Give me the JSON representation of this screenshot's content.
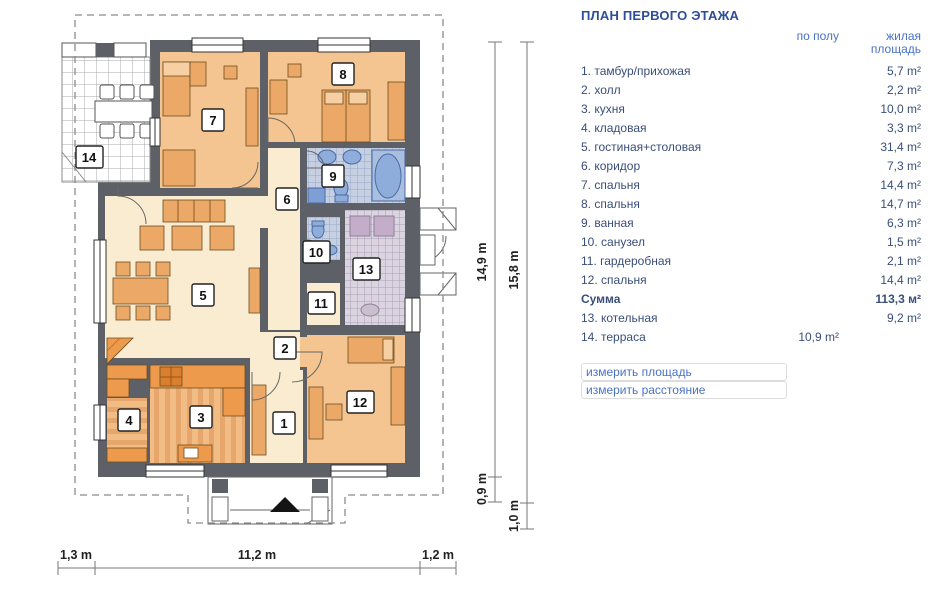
{
  "panel": {
    "title": "ПЛАН ПЕРВОГО ЭТАЖА",
    "col1_header": "по полу",
    "col2_header": "жилая площадь",
    "rows": [
      {
        "name": "1. тамбур/прихожая",
        "c1": "",
        "c2": "5,7 m²"
      },
      {
        "name": "2. холл",
        "c1": "",
        "c2": "2,2 m²"
      },
      {
        "name": "3. кухня",
        "c1": "",
        "c2": "10,0 m²"
      },
      {
        "name": "4. кладовая",
        "c1": "",
        "c2": "3,3 m²"
      },
      {
        "name": "5. гостиная+столовая",
        "c1": "",
        "c2": "31,4 m²"
      },
      {
        "name": "6. коридор",
        "c1": "",
        "c2": "7,3 m²"
      },
      {
        "name": "7. спальня",
        "c1": "",
        "c2": "14,4 m²"
      },
      {
        "name": "8. спальня",
        "c1": "",
        "c2": "14,7 m²"
      },
      {
        "name": "9. ванная",
        "c1": "",
        "c2": "6,3 m²"
      },
      {
        "name": "10. санузел",
        "c1": "",
        "c2": "1,5 m²"
      },
      {
        "name": "11. гардеробная",
        "c1": "",
        "c2": "2,1 m²"
      },
      {
        "name": "12. спальня",
        "c1": "",
        "c2": "14,4 m²"
      },
      {
        "name": "Сумма",
        "c1": "",
        "c2": "113,3 м²"
      },
      {
        "name": "13. котельная",
        "c1": "",
        "c2": "9,2 m²"
      },
      {
        "name": "14. терраса",
        "c1": "10,9 m²",
        "c2": ""
      }
    ],
    "link_area": "измерить площадь",
    "link_distance": "измерить расстояние"
  },
  "plan": {
    "room_numbers": [
      "1",
      "2",
      "3",
      "4",
      "5",
      "6",
      "7",
      "8",
      "9",
      "10",
      "11",
      "12",
      "13",
      "14"
    ],
    "dimensions": {
      "right_inner": "14,9 m",
      "right_outer": "15,8 m",
      "right_inner_low": "0,9 m",
      "right_outer_low": "1,0 m",
      "bottom_left": "1,3 m",
      "bottom_mid": "11,2 m",
      "bottom_right": "1,2 m"
    }
  },
  "colors": {
    "wall": "#5d6167",
    "cream_floor": "#f9ecd0",
    "peach_floor": "#f4c591",
    "furniture": "#eba867",
    "counter": "#ee9a4c",
    "bath_fixture": "#8fadda",
    "title_blue": "#2c4d9b",
    "link_blue": "#4a72c4",
    "row_text": "#394e79"
  }
}
